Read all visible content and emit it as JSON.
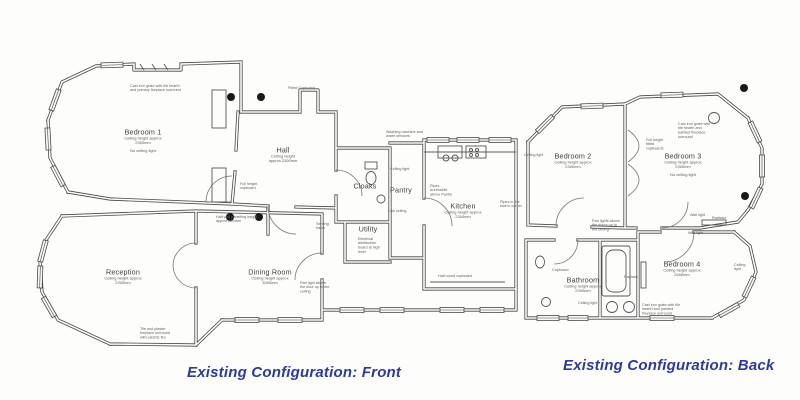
{
  "colors": {
    "paper": "#fdfdfc",
    "wall_line": "#474747",
    "note_text": "#5f5f5f",
    "caption_blue": "#2b3a9c",
    "ceiling_dot": "#191919"
  },
  "front": {
    "caption": "Existing Configuration: Front",
    "rooms": {
      "bedroom1": {
        "label": "Bedroom 1",
        "sub1": "Ceiling height approx",
        "sub2": "2300mm",
        "sub3": "No ceiling light"
      },
      "hall": {
        "label": "Hall",
        "sub1": "Ceiling height",
        "sub2": "approx 2300mm"
      },
      "cloaks": {
        "label": "Cloaks"
      },
      "pantry": {
        "label": "Pantry"
      },
      "kitchen": {
        "label": "Kitchen",
        "sub1": "Ceiling height approx",
        "sub2": "2300mm"
      },
      "utility": {
        "label": "Utility"
      },
      "reception": {
        "label": "Reception",
        "sub1": "Ceiling height approx",
        "sub2": "2300mm"
      },
      "dining": {
        "label": "Dining Room",
        "sub1": "Ceiling height approx",
        "sub2": "3000mm"
      }
    },
    "notes": {
      "fireplace_b1": "Cast iron grate with tile hearth and primary fireplace surround",
      "fitted_cupboard": "Fitted Cupboard",
      "full_height_cupboard": "Full height cupboard",
      "washing_services": "Washing machine and water services",
      "ceiling_light_pantry": "Ceiling light",
      "low_ceiling_pantry": "Low ceiling",
      "pipes_pantry": "Pipes accessible above Pantry",
      "pipes_corner": "Pipes in the wall in corner",
      "half_round_cupboard": "Half round cupboard",
      "serving_hatch": "Serving hatch",
      "distribution_board": "Electrical distribution board at high level",
      "part_light_door": "Part light above the door up to the ceiling",
      "half_wall_panelling": "Half wall panelling height approx 800mm",
      "reception_fireplace": "Tile and plaster fireplace surround with electric fire"
    }
  },
  "back": {
    "caption": "Existing Configuration: Back",
    "rooms": {
      "bedroom2": {
        "label": "Bedroom 2",
        "sub1": "Ceiling height approx",
        "sub2": "2300mm"
      },
      "bedroom3": {
        "label": "Bedroom 3",
        "sub1": "Ceiling height approx",
        "sub2": "2300mm",
        "sub3": "No ceiling light"
      },
      "bathroom": {
        "label": "Bathroom",
        "sub1": "Ceiling height approx",
        "sub2": "2300mm"
      },
      "bedroom4": {
        "label": "Bedroom 4",
        "sub1": "Ceiling height approx",
        "sub2": "2600mm"
      }
    },
    "notes": {
      "ceiling_light_b2": "Ceiling light",
      "fitted_cupboards": "Full height fitted cupboards",
      "fireplace_b3": "Cast iron grate with tile hearth and painted fireplace surround",
      "wall_light_b3": "Wall light",
      "radiator_b3": "Radiator",
      "part_lights_doors": "Part lights above the doors up to the ceiling",
      "cupboard_bathroom": "Cupboard",
      "ceiling_light_bathroom": "Ceiling light",
      "radiator_bathroom": "Radiator",
      "wall_light_b4": "Wall light",
      "ceiling_light_b4": "Ceiling light",
      "fireplace_b4": "Cast iron grate with tile hearth and painted fireplace surround"
    }
  }
}
